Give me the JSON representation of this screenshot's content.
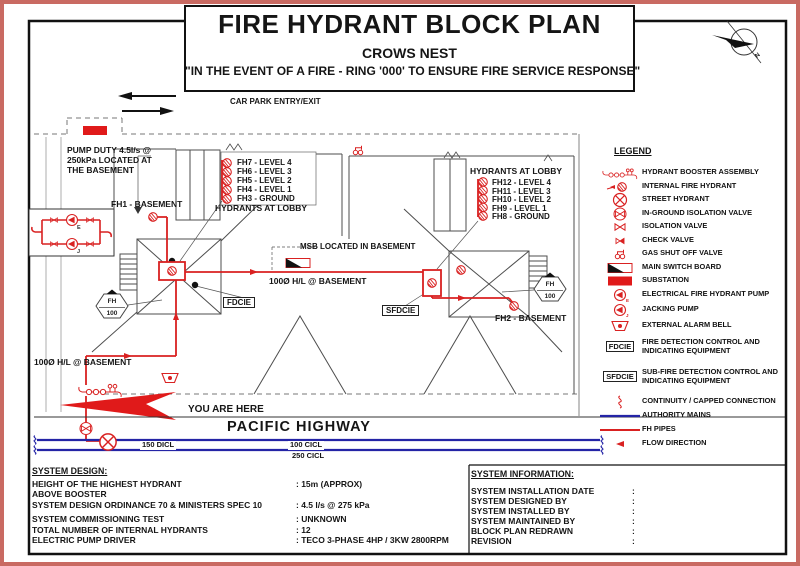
{
  "title_block": {
    "title": "FIRE HYDRANT BLOCK PLAN",
    "subtitle": "CROWS NEST",
    "warning": "\"IN THE EVENT OF A FIRE - RING '000' TO ENSURE FIRE SERVICE RESPONSE\""
  },
  "compass": {
    "north_label": "N"
  },
  "pump_labels": {
    "electrical": "E",
    "jacking": "J"
  },
  "site": {
    "car_park": "CAR PARK ENTRY/EXIT",
    "pump_duty_note": "PUMP DUTY 4.5l/s @ 250kPa LOCATED AT THE BASEMENT",
    "msb_note": "MSB LOCATED IN BASEMENT",
    "pipe_label_main": "100Ø H/L @ BASEMENT",
    "pipe_label_lower": "100Ø H/L @ BASEMENT",
    "you_are_here": "YOU ARE HERE",
    "highway": "PACIFIC HIGHWAY",
    "mains_labels": [
      "150 DICL",
      "100 CICL",
      "250 CICL"
    ],
    "fdcie": "FDCIE",
    "sfdcie": "SFDCIE",
    "fh1": "FH1 - BASEMENT",
    "fh2": "FH2 - BASEMENT",
    "hex_marker": {
      "line1": "FH",
      "line2": "100"
    },
    "left_lobby": {
      "items": [
        "FH7 - LEVEL 4",
        "FH6 - LEVEL 3",
        "FH5 - LEVEL 2",
        "FH4 - LEVEL 1",
        "FH3 - GROUND"
      ],
      "caption": "HYDRANTS AT LOBBY"
    },
    "right_lobby": {
      "caption": "HYDRANTS AT LOBBY",
      "items": [
        "FH12 - LEVEL 4",
        "FH11 - LEVEL 3",
        "FH10 - LEVEL 2",
        "FH9 - LEVEL 1",
        "FH8 - GROUND"
      ]
    }
  },
  "legend": {
    "title": "LEGEND",
    "items": [
      {
        "label": "HYDRANT BOOSTER ASSEMBLY"
      },
      {
        "label": "INTERNAL FIRE HYDRANT"
      },
      {
        "label": "STREET HYDRANT"
      },
      {
        "label": "IN-GROUND ISOLATION VALVE"
      },
      {
        "label": "ISOLATION VALVE"
      },
      {
        "label": "CHECK VALVE"
      },
      {
        "label": "GAS SHUT OFF VALVE"
      },
      {
        "label": "MAIN SWITCH BOARD"
      },
      {
        "label": "SUBSTATION"
      },
      {
        "label": "ELECTRICAL FIRE HYDRANT PUMP"
      },
      {
        "label": "JACKING PUMP"
      },
      {
        "label": "EXTERNAL ALARM BELL"
      },
      {
        "symbol": "FDCIE",
        "label": "FIRE DETECTION CONTROL AND INDICATING EQUIPMENT"
      },
      {
        "symbol": "SFDCIE",
        "label": "SUB-FIRE DETECTION CONTROL AND INDICATING EQUIPMENT"
      },
      {
        "label": "CONTINUITY / CAPPED CONNECTION"
      },
      {
        "label": "AUTHORITY MAINS"
      },
      {
        "label": "FH PIPES"
      },
      {
        "label": "FLOW DIRECTION"
      }
    ]
  },
  "system_design": {
    "heading": "SYSTEM DESIGN:",
    "rows": [
      {
        "label": "HEIGHT OF THE HIGHEST HYDRANT",
        "value": ": 15m (APPROX)"
      },
      {
        "label": "ABOVE BOOSTER",
        "value": ""
      },
      {
        "label": "SYSTEM DESIGN ORDINANCE 70 & MINISTERS SPEC 10",
        "value": ": 4.5 l/s @ 275 kPa"
      },
      {
        "label": "SYSTEM COMMISSIONING TEST",
        "value": ": UNKNOWN"
      },
      {
        "label": "TOTAL NUMBER OF INTERNAL HYDRANTS",
        "value": ": 12"
      },
      {
        "label": "ELECTRIC PUMP DRIVER",
        "value": ": TECO 3-PHASE 4HP / 3KW 2800RPM"
      }
    ]
  },
  "system_information": {
    "heading": "SYSTEM INFORMATION:",
    "rows": [
      {
        "label": "SYSTEM INSTALLATION DATE",
        "value": ":"
      },
      {
        "label": "SYSTEM DESIGNED BY",
        "value": ":"
      },
      {
        "label": "SYSTEM INSTALLED BY",
        "value": ":"
      },
      {
        "label": "SYSTEM MAINTAINED BY",
        "value": ":"
      },
      {
        "label": "BLOCK PLAN REDRAWN",
        "value": ":"
      },
      {
        "label": "REVISION",
        "value": ":"
      }
    ]
  },
  "colors": {
    "pipe_red": "#d92121",
    "mains_blue": "#2424a6",
    "border_red": "#c96a62"
  }
}
